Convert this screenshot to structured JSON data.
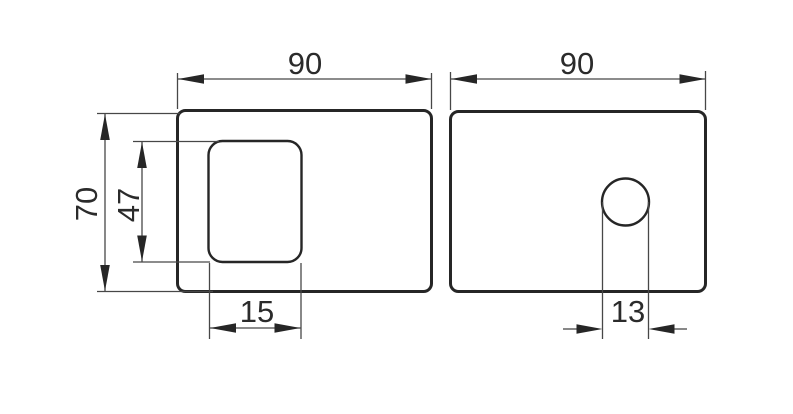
{
  "drawing": {
    "type": "technical-drawing",
    "description": "Two-view dimensioned engineering drawing: left view of a plate with a rounded rectangular slot, right view of a plate with a circular hole",
    "background": "#ffffff",
    "colors": {
      "outline": "#262626",
      "dimension_lines": "#474747",
      "labels": "#2b2b2b"
    },
    "left_view": {
      "width": "90",
      "height": "70",
      "slot_height": "47",
      "slot_width": "15"
    },
    "right_view": {
      "width": "90",
      "hole_width": "13"
    }
  }
}
